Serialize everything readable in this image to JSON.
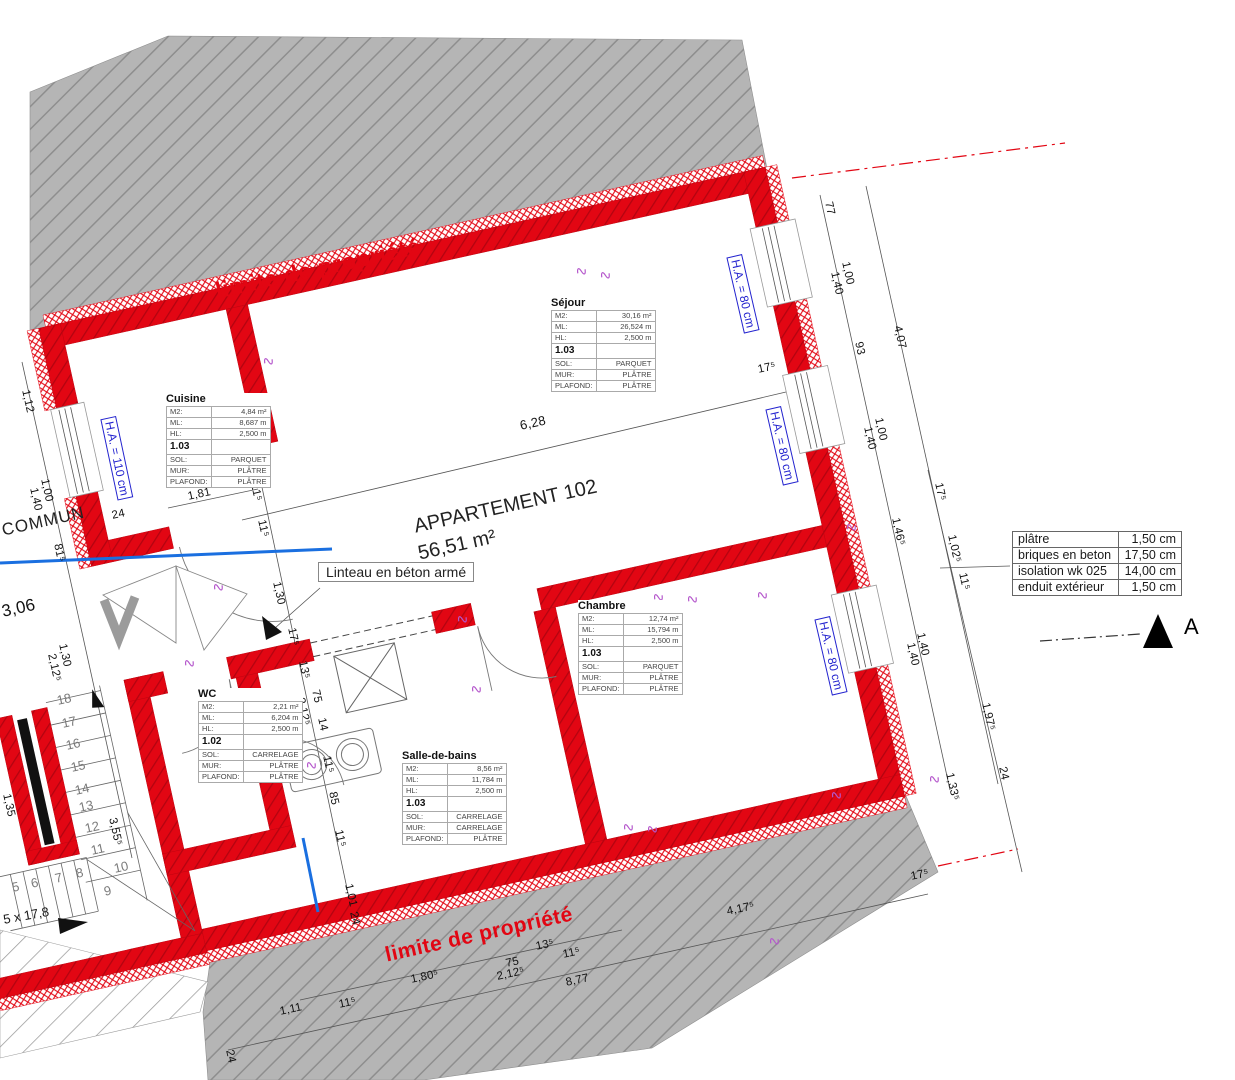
{
  "drawing": {
    "property_line_top": "limite de propriété",
    "property_line_bottom": "limite de propriété",
    "apartment_name": "APPARTEMENT 102",
    "apartment_area": "56,51 m²",
    "lintel_note": "Linteau en béton armé",
    "common_area_label": "COMMUN",
    "stair_note": "5 x 17,8",
    "section_marker": "A",
    "colors": {
      "wall_red": "#e20613",
      "annotation_blue": "#2323cf",
      "hatch_gray": "#b5b5b5",
      "line_blue": "#1a6fe0"
    }
  },
  "legend": {
    "rows": [
      {
        "material": "plâtre",
        "thickness": "1,50 cm"
      },
      {
        "material": "briques en beton",
        "thickness": "17,50 cm"
      },
      {
        "material": "isolation wk 025",
        "thickness": "14,00 cm"
      },
      {
        "material": "enduit extérieur",
        "thickness": "1,50 cm"
      }
    ]
  },
  "room_row_labels": {
    "m2": "M2:",
    "ml": "ML:",
    "hl": "HL:",
    "sol": "SOL:",
    "mur": "MUR:",
    "plafond": "PLAFOND:"
  },
  "rooms": [
    {
      "name": "Séjour",
      "m2": "30,16 m²",
      "ml": "26,524 m",
      "hl": "2,500 m",
      "code": "1.03",
      "sol": "PARQUET",
      "mur": "PLÂTRE",
      "plafond": "PLÂTRE",
      "x": 551,
      "y": 297
    },
    {
      "name": "Cuisine",
      "m2": "4,84 m²",
      "ml": "8,687 m",
      "hl": "2,500 m",
      "code": "1.03",
      "sol": "PARQUET",
      "mur": "PLÂTRE",
      "plafond": "PLÂTRE",
      "x": 166,
      "y": 393
    },
    {
      "name": "Chambre",
      "m2": "12,74 m²",
      "ml": "15,794 m",
      "hl": "2,500 m",
      "code": "1.03",
      "sol": "PARQUET",
      "mur": "PLÂTRE",
      "plafond": "PLÂTRE",
      "x": 578,
      "y": 600
    },
    {
      "name": "WC",
      "m2": "2,21 m²",
      "ml": "6,204 m",
      "hl": "2,500 m",
      "code": "1.02",
      "sol": "CARRELAGE",
      "mur": "PLÂTRE",
      "plafond": "PLÂTRE",
      "x": 198,
      "y": 688
    },
    {
      "name": "Salle-de-bains",
      "m2": "8,56 m²",
      "ml": "11,784 m",
      "hl": "2,500 m",
      "code": "1.03",
      "sol": "CARRELAGE",
      "mur": "CARRELAGE",
      "plafond": "PLÂTRE",
      "x": 402,
      "y": 750
    }
  ],
  "window_labels": [
    {
      "t": "H.A. = 110 cm",
      "x": 116,
      "y": 416,
      "r": 78
    },
    {
      "t": "H.A. = 80 cm",
      "x": 742,
      "y": 254,
      "r": 77
    },
    {
      "t": "H.A. = 80 cm",
      "x": 781,
      "y": 406,
      "r": 77
    },
    {
      "t": "H.A. = 80 cm",
      "x": 830,
      "y": 616,
      "r": 77
    }
  ],
  "dims": [
    {
      "t": "77",
      "x": 828,
      "y": 196,
      "r": 77
    },
    {
      "t": "1,00",
      "x": 845,
      "y": 256,
      "r": 77
    },
    {
      "t": "1,40",
      "x": 834,
      "y": 266,
      "r": 77
    },
    {
      "t": "93",
      "x": 858,
      "y": 336,
      "r": 77
    },
    {
      "t": "4,07",
      "x": 897,
      "y": 320,
      "r": 77
    },
    {
      "t": "1,00",
      "x": 878,
      "y": 412,
      "r": 77
    },
    {
      "t": "1,40",
      "x": 867,
      "y": 421,
      "r": 77
    },
    {
      "t": "17⁵",
      "x": 758,
      "y": 364,
      "r": -12.5
    },
    {
      "t": "17⁵",
      "x": 938,
      "y": 477,
      "r": 77
    },
    {
      "t": "1,46⁵",
      "x": 895,
      "y": 512,
      "r": 77
    },
    {
      "t": "1,02⁵",
      "x": 951,
      "y": 529,
      "r": 77
    },
    {
      "t": "11⁵",
      "x": 962,
      "y": 567,
      "r": 77
    },
    {
      "t": "1,40",
      "x": 920,
      "y": 627,
      "r": 77
    },
    {
      "t": "1,40",
      "x": 910,
      "y": 637,
      "r": 77
    },
    {
      "t": "1,97⁵",
      "x": 985,
      "y": 697,
      "r": 77
    },
    {
      "t": "1,33⁵",
      "x": 949,
      "y": 767,
      "r": 77
    },
    {
      "t": "24",
      "x": 1002,
      "y": 761,
      "r": 77
    },
    {
      "t": "17⁵",
      "x": 911,
      "y": 871,
      "r": -12.5
    },
    {
      "t": "4,17⁵",
      "x": 727,
      "y": 906,
      "r": -12.5
    },
    {
      "t": "8,77",
      "x": 566,
      "y": 977,
      "r": -12.5
    },
    {
      "t": "13⁵",
      "x": 536,
      "y": 941,
      "r": -12.5
    },
    {
      "t": "11⁵",
      "x": 563,
      "y": 949,
      "r": -12.5
    },
    {
      "t": "75",
      "x": 506,
      "y": 958,
      "r": -12.5
    },
    {
      "t": "2,12⁵",
      "x": 497,
      "y": 971,
      "r": -12.5
    },
    {
      "t": "1,80⁵",
      "x": 411,
      "y": 974,
      "r": -12.5
    },
    {
      "t": "1,11",
      "x": 280,
      "y": 1006,
      "r": -12.5
    },
    {
      "t": "11⁵",
      "x": 339,
      "y": 999,
      "r": -12.5
    },
    {
      "t": "24",
      "x": 229,
      "y": 1044,
      "r": 77
    },
    {
      "t": "6,28",
      "x": 520,
      "y": 418,
      "r": -12.5,
      "s": 13
    },
    {
      "t": "1,81",
      "x": 188,
      "y": 491,
      "r": -12.5
    },
    {
      "t": "11⁵",
      "x": 254,
      "y": 478,
      "r": 77
    },
    {
      "t": "11⁵",
      "x": 261,
      "y": 514,
      "r": 77
    },
    {
      "t": "2,49",
      "x": 237,
      "y": 408,
      "r": 77,
      "s": 13
    },
    {
      "t": "1,30",
      "x": 276,
      "y": 576,
      "r": 77
    },
    {
      "t": "17⁵",
      "x": 291,
      "y": 622,
      "r": 77
    },
    {
      "t": "13⁵",
      "x": 302,
      "y": 655,
      "r": 77
    },
    {
      "t": "75",
      "x": 315,
      "y": 684,
      "r": 77
    },
    {
      "t": "2,12⁵",
      "x": 300,
      "y": 692,
      "r": 77
    },
    {
      "t": "14",
      "x": 321,
      "y": 712,
      "r": 77
    },
    {
      "t": "11⁵",
      "x": 326,
      "y": 750,
      "r": 77
    },
    {
      "t": "85",
      "x": 332,
      "y": 786,
      "r": 77
    },
    {
      "t": "11⁵",
      "x": 338,
      "y": 824,
      "r": 77
    },
    {
      "t": "1,01",
      "x": 348,
      "y": 878,
      "r": 77
    },
    {
      "t": "24",
      "x": 353,
      "y": 906,
      "r": 77
    },
    {
      "t": "1,12",
      "x": 25,
      "y": 384,
      "r": 77
    },
    {
      "t": "1,00",
      "x": 44,
      "y": 473,
      "r": 77
    },
    {
      "t": "1,40",
      "x": 33,
      "y": 482,
      "r": 77
    },
    {
      "t": "81⁵",
      "x": 57,
      "y": 538,
      "r": 77
    },
    {
      "t": "24",
      "x": 112,
      "y": 510,
      "r": -12.5
    },
    {
      "t": "3,06",
      "x": 2,
      "y": 602,
      "r": -12.5,
      "s": 17
    },
    {
      "t": "1,30",
      "x": 62,
      "y": 638,
      "r": 77
    },
    {
      "t": "2,12⁵",
      "x": 51,
      "y": 648,
      "r": 77
    },
    {
      "t": "3,55⁵",
      "x": 112,
      "y": 812,
      "r": 77
    },
    {
      "t": "1,35",
      "x": 6,
      "y": 788,
      "r": 77
    }
  ],
  "stair_numbers": [
    {
      "t": "5",
      "x": 12,
      "y": 880
    },
    {
      "t": "6",
      "x": 31,
      "y": 876
    },
    {
      "t": "7",
      "x": 55,
      "y": 871
    },
    {
      "t": "8",
      "x": 76,
      "y": 866
    },
    {
      "t": "9",
      "x": 104,
      "y": 884
    },
    {
      "t": "10",
      "x": 114,
      "y": 861
    },
    {
      "t": "11",
      "x": 91,
      "y": 843
    },
    {
      "t": "12",
      "x": 85,
      "y": 821
    },
    {
      "t": "13",
      "x": 79,
      "y": 800
    },
    {
      "t": "14",
      "x": 75,
      "y": 783
    },
    {
      "t": "15",
      "x": 71,
      "y": 760
    },
    {
      "t": "16",
      "x": 66,
      "y": 738
    },
    {
      "t": "17",
      "x": 62,
      "y": 716
    },
    {
      "t": "18",
      "x": 57,
      "y": 693
    }
  ],
  "symbols": [
    {
      "x": 575,
      "y": 262
    },
    {
      "x": 599,
      "y": 266
    },
    {
      "x": 262,
      "y": 352
    },
    {
      "x": 212,
      "y": 578
    },
    {
      "x": 183,
      "y": 654
    },
    {
      "x": 456,
      "y": 610
    },
    {
      "x": 652,
      "y": 588
    },
    {
      "x": 686,
      "y": 590
    },
    {
      "x": 845,
      "y": 518
    },
    {
      "x": 928,
      "y": 770
    },
    {
      "x": 830,
      "y": 786
    },
    {
      "x": 622,
      "y": 818
    },
    {
      "x": 646,
      "y": 820
    },
    {
      "x": 470,
      "y": 680
    },
    {
      "x": 768,
      "y": 932
    },
    {
      "x": 305,
      "y": 756
    },
    {
      "x": 756,
      "y": 586
    }
  ]
}
